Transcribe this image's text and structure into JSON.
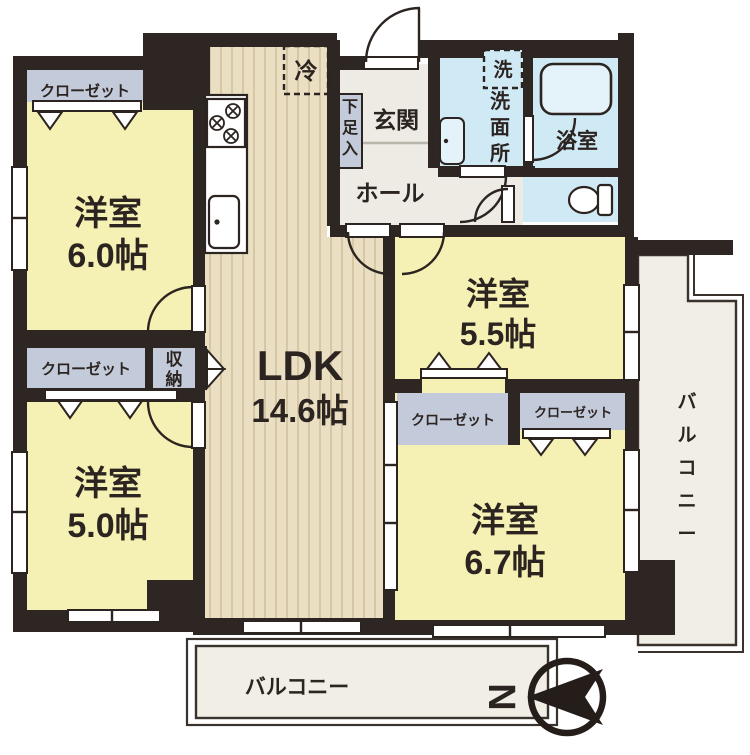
{
  "plan": {
    "rooms": {
      "bedroom_nw": {
        "name": "洋室",
        "size": "6.0帖"
      },
      "bedroom_sw": {
        "name": "洋室",
        "size": "5.0帖"
      },
      "bedroom_ne": {
        "name": "洋室",
        "size": "5.5帖"
      },
      "bedroom_se": {
        "name": "洋室",
        "size": "6.7帖"
      },
      "ldk": {
        "name": "LDK",
        "size": "14.6帖"
      }
    },
    "labels": {
      "closet": "クローゼット",
      "storage": "収納",
      "refrigerator": "冷",
      "entrance": "玄関",
      "shoe_cabinet": "下足入",
      "hall": "ホール",
      "washer": "洗",
      "washroom": "洗面所",
      "bathroom": "浴室",
      "balcony": "バルコニー",
      "north": "N"
    },
    "colors": {
      "wall": "#2e2622",
      "room_yellow": "#f5f0b4",
      "closet_blue": "#c3cbdb",
      "water_blue": "#cfe9f5",
      "wood": "#eadfc2",
      "wood_line": "#d2c39c",
      "floor_gray": "#edebe3",
      "balcony": "#f1eee5"
    }
  }
}
